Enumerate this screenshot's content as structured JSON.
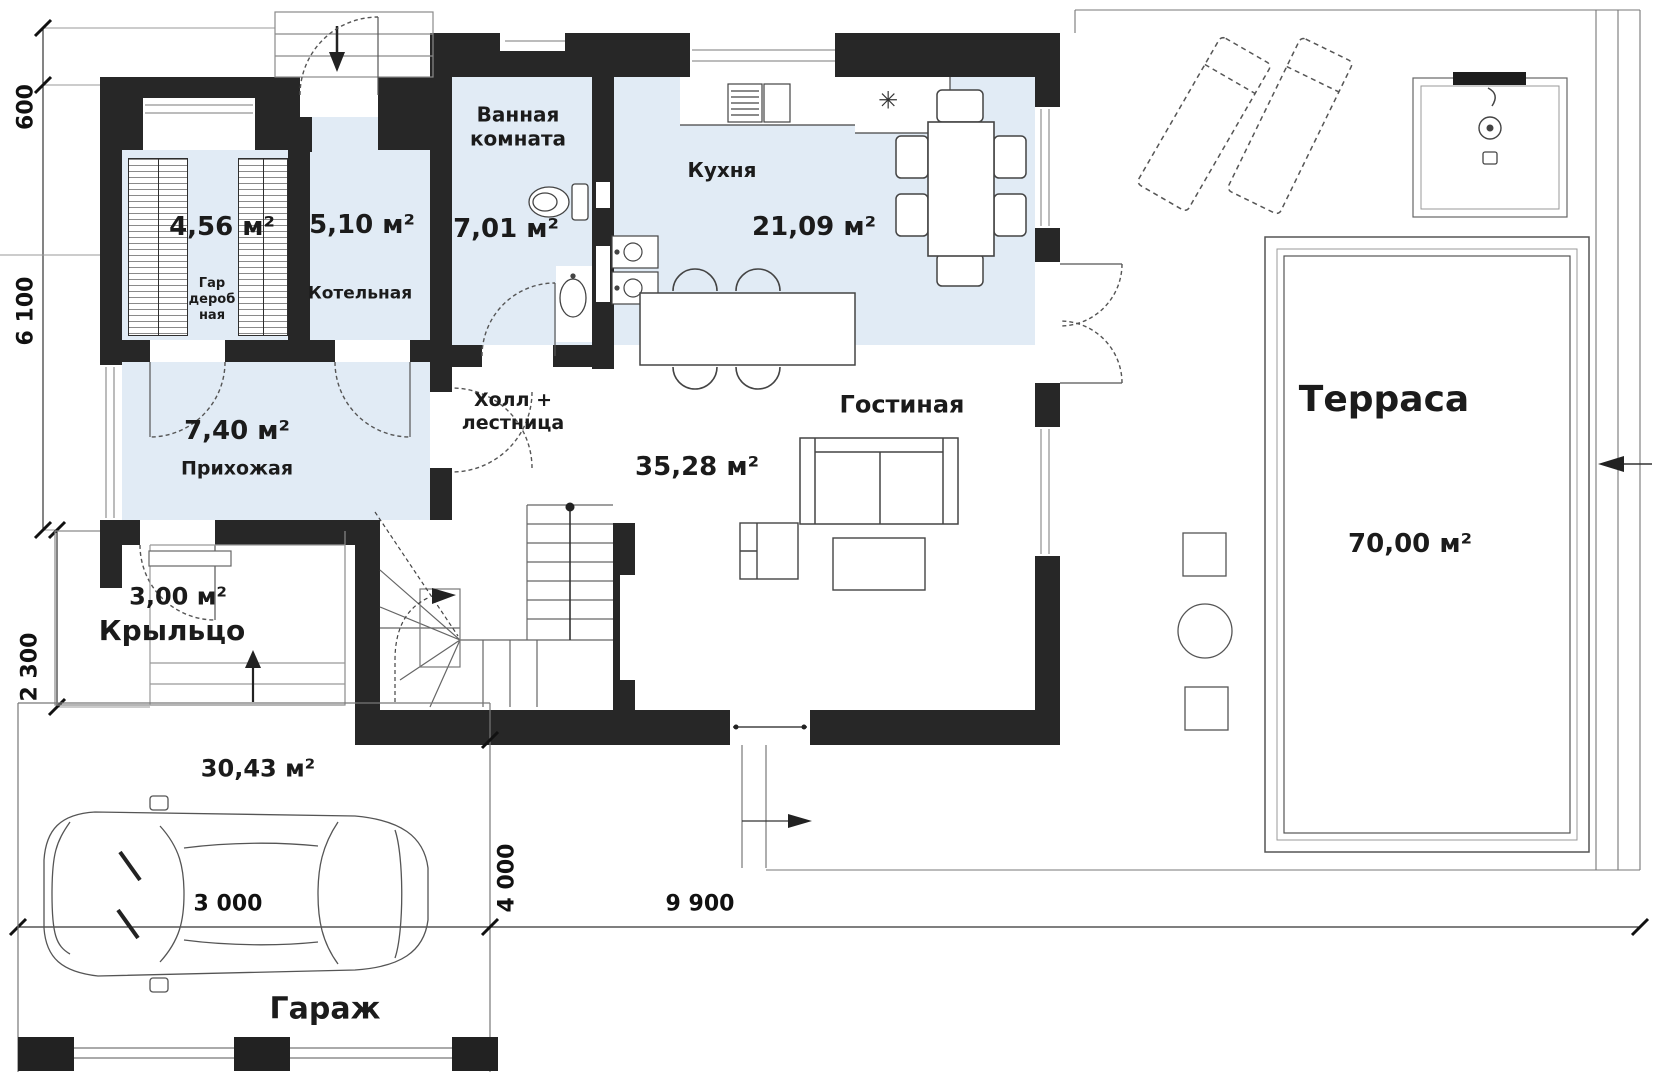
{
  "rooms": {
    "wardrobe": {
      "name_line1": "Гар",
      "name_line2": "дероб",
      "name_line3": "ная",
      "area": "4,56 м²"
    },
    "boiler": {
      "name": "Котельная",
      "area": "5,10 м²"
    },
    "bathroom": {
      "name_line1": "Ванная",
      "name_line2": "комната",
      "area": "7,01 м²"
    },
    "kitchen": {
      "name": "Кухня",
      "area": "21,09 м²"
    },
    "hallway": {
      "name": "Прихожая",
      "area": "7,40 м²"
    },
    "hall_stairs": {
      "name_line1": "Холл +",
      "name_line2": "лестница"
    },
    "living": {
      "name": "Гостиная",
      "area": "35,28 м²"
    },
    "porch": {
      "name": "Крыльцо",
      "area": "3,00 м²"
    },
    "garage": {
      "name": "Гараж",
      "area": "30,43 м²"
    },
    "terrace": {
      "name": "Терраса",
      "area": "70,00 м²"
    }
  },
  "dimensions": {
    "left_top": "600",
    "left_middle": "6 100",
    "left_bottom": "2 300",
    "garage_width": "3 000",
    "yard_depth": "4 000",
    "bottom_span": "9 900"
  },
  "icons": {
    "fridge": "✳"
  },
  "colors": {
    "wall": "#272727",
    "room_fill": "#e1ebf5",
    "line": "#555555",
    "background": "#ffffff"
  }
}
